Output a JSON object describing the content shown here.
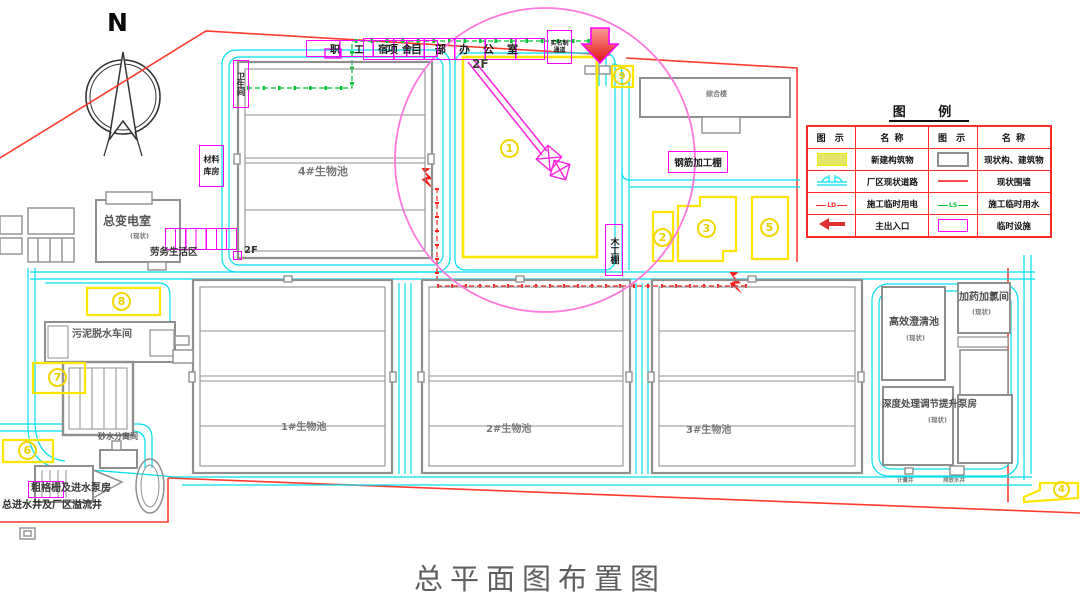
{
  "page": {
    "title": "总平面图布置图"
  },
  "compass": {
    "label": "N"
  },
  "colors": {
    "new_structure": "#FFFF00",
    "existing_structure": "#8F8F8F",
    "existing_road": "#00E0EE",
    "existing_wall": "#FF3B30",
    "temp_power": "#FF2020",
    "temp_water": "#00CC33",
    "temp_facility": "#FF00FF",
    "entrance_arrow": "#E03030",
    "crane_circle": "#FF77DD"
  },
  "legend": {
    "title": "图  例",
    "headers": [
      "图 示",
      "名 称",
      "图 示",
      "名 称"
    ],
    "rows": [
      {
        "left_name": "新建构筑物",
        "right_name": "现状构、建筑物"
      },
      {
        "left_name": "厂区现状道路",
        "right_name": "现状围墙"
      },
      {
        "left_name": "施工临时用电",
        "left_tag": "LD",
        "right_name": "施工临时用水",
        "right_tag": "LS"
      },
      {
        "left_name": "主出入口",
        "right_name": "临时设施"
      }
    ]
  },
  "buildings": {
    "bio_pool_4": "4#生物池",
    "bio_pool_1": "1#生物池",
    "bio_pool_2": "2#生物池",
    "bio_pool_3": "3#生物池",
    "main_substation": "总变电室",
    "main_substation_note": "(现状)",
    "sludge_dewatering": "污泥脱水车间",
    "sand_water_separation": "砂水分离间",
    "coarse_screen_pump": "粗格栅及进水泵房",
    "main_inlet_well": "总进水井及厂区溢流井",
    "clarifier": "高效澄清池",
    "clarifier_note": "(现状)",
    "dosing_room": "加药加氯间",
    "dosing_note": "(现状)",
    "deep_treatment_pump": "深度处理调节提升泵房",
    "deep_treatment_note": "(现状)",
    "admin_building": "综合楼",
    "meter_well": "计量井",
    "discharge_well": "排放水井",
    "floor_2f": "2F"
  },
  "temp_facilities": {
    "project_office": "项目部办公室",
    "staff_dormitory": "职工宿舍",
    "toilet": "卫生间",
    "material_warehouse": "材料库房",
    "labor_living_area": "劳务生活区",
    "labor_floor": "2F",
    "rebar_shed": "钢筋加工棚",
    "carpentry_shed": "木工棚",
    "realname_channel": "实名制通道"
  },
  "markers": {
    "m1": "1",
    "m2": "2",
    "m3": "3",
    "m4": "4",
    "m5": "5",
    "m6": "6",
    "m7": "7",
    "m8": "8",
    "m9": "9"
  }
}
